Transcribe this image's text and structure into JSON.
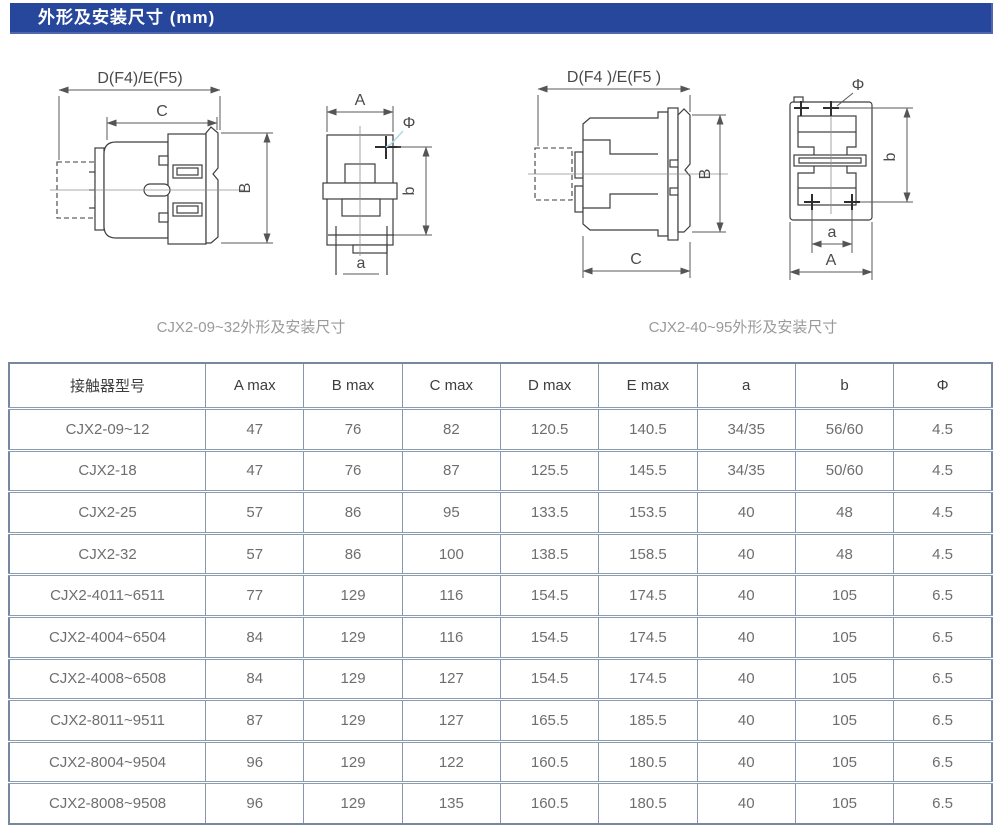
{
  "header": {
    "title": "外形及安装尺寸 (mm)",
    "bar_color": "#27479d",
    "text_color": "#ffffff"
  },
  "figures": {
    "left": {
      "caption": "CJX2-09~32外形及安装尺寸",
      "labels": {
        "d": "D(F4)/E(F5)",
        "c": "C",
        "B": "B",
        "A": "A",
        "phi": "Φ",
        "b": "b",
        "a": "a"
      }
    },
    "right": {
      "caption": "CJX2-40~95外形及安装尺寸",
      "labels": {
        "d": "D(F4 )/E(F5 )",
        "c": "C",
        "B": "B",
        "A": "A",
        "phi": "Φ",
        "b": "b",
        "a": "a"
      }
    }
  },
  "table": {
    "headers": [
      "接触器型号",
      "A max",
      "B max",
      "C max",
      "D max",
      "E max",
      "a",
      "b",
      "Φ"
    ],
    "rows": [
      [
        "CJX2-09~12",
        "47",
        "76",
        "82",
        "120.5",
        "140.5",
        "34/35",
        "56/60",
        "4.5"
      ],
      [
        "CJX2-18",
        "47",
        "76",
        "87",
        "125.5",
        "145.5",
        "34/35",
        "50/60",
        "4.5"
      ],
      [
        "CJX2-25",
        "57",
        "86",
        "95",
        "133.5",
        "153.5",
        "40",
        "48",
        "4.5"
      ],
      [
        "CJX2-32",
        "57",
        "86",
        "100",
        "138.5",
        "158.5",
        "40",
        "48",
        "4.5"
      ],
      [
        "CJX2-4011~6511",
        "77",
        "129",
        "116",
        "154.5",
        "174.5",
        "40",
        "105",
        "6.5"
      ],
      [
        "CJX2-4004~6504",
        "84",
        "129",
        "116",
        "154.5",
        "174.5",
        "40",
        "105",
        "6.5"
      ],
      [
        "CJX2-4008~6508",
        "84",
        "129",
        "127",
        "154.5",
        "174.5",
        "40",
        "105",
        "6.5"
      ],
      [
        "CJX2-8011~9511",
        "87",
        "129",
        "127",
        "165.5",
        "185.5",
        "40",
        "105",
        "6.5"
      ],
      [
        "CJX2-8004~9504",
        "96",
        "129",
        "122",
        "160.5",
        "180.5",
        "40",
        "105",
        "6.5"
      ],
      [
        "CJX2-8008~9508",
        "96",
        "129",
        "135",
        "160.5",
        "180.5",
        "40",
        "105",
        "6.5"
      ]
    ]
  },
  "colors": {
    "table_border": "#8696ac",
    "table_outer_border": "#76879f",
    "header_text": "#3d3d3d",
    "cell_text": "#6e6e6e",
    "caption_text": "#9a9a9a",
    "drawing_line": "#3e3e3e",
    "phi_leader_blue": "#a9d9e6"
  }
}
